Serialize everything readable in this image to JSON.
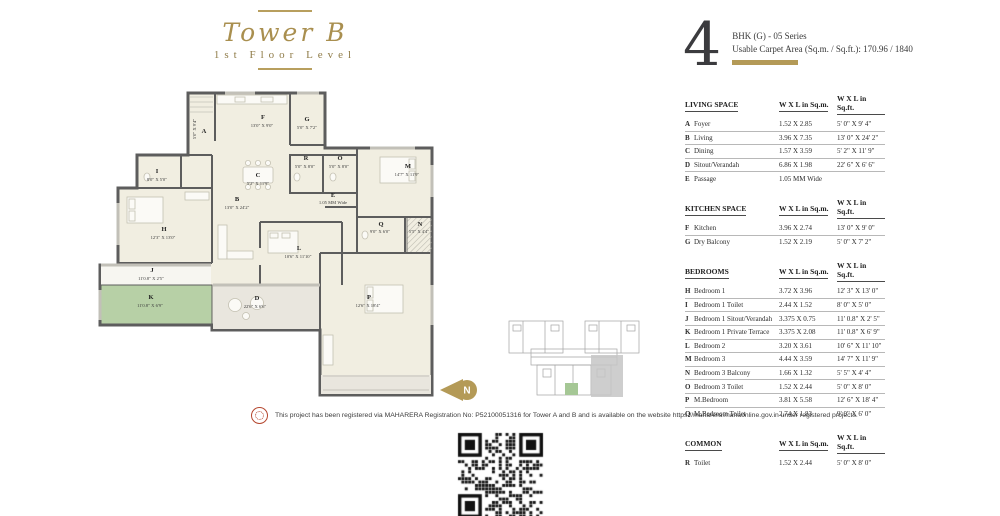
{
  "header": {
    "tower": "Tower B",
    "floor": "1st Floor Level",
    "unit_number": "4",
    "unit_series": "BHK (G)  - 05 Series",
    "carpet_area": "Usable Carpet Area (Sq.m. / Sq.ft.): 170.96 / 1840"
  },
  "tables": [
    {
      "title": "LIVING SPACE",
      "col1": "W X L in Sq.m.",
      "col2": "W X L in Sq.ft.",
      "rows": [
        [
          "A",
          "Foyer",
          "1.52 X 2.85",
          "5' 0\" X 9' 4\""
        ],
        [
          "B",
          "Living",
          "3.96 X 7.35",
          "13' 0\" X 24' 2\""
        ],
        [
          "C",
          "Dining",
          "1.57 X 3.59",
          "5' 2\" X 11' 9\""
        ],
        [
          "D",
          "Sitout/Verandah",
          "6.86 X 1.98",
          "22' 6\" X 6' 6\""
        ],
        [
          "E",
          "Passage",
          "1.05 MM Wide",
          ""
        ]
      ]
    },
    {
      "title": "KITCHEN SPACE",
      "col1": "W X L in Sq.m.",
      "col2": "W X L in Sq.ft.",
      "rows": [
        [
          "F",
          "Kitchen",
          "3.96 X 2.74",
          "13' 0\" X 9' 0\""
        ],
        [
          "G",
          "Dry Balcony",
          "1.52 X 2.19",
          "5' 0\" X 7' 2\""
        ]
      ]
    },
    {
      "title": "BEDROOMS",
      "col1": "W X L in Sq.m.",
      "col2": "W X L in Sq.ft.",
      "rows": [
        [
          "H",
          "Bedroom 1",
          "3.72 X 3.96",
          "12' 3\" X 13' 0\""
        ],
        [
          "I",
          "Bedroom 1 Toilet",
          "2.44 X 1.52",
          "8' 0\" X 5' 0\""
        ],
        [
          "J",
          "Bedroom 1 Sitout/Verandah",
          "3.375 X 0.75",
          "11' 0.8\" X 2' 5\""
        ],
        [
          "K",
          "Bedroom 1 Private Terrace",
          "3.375 X 2.08",
          "11' 0.8\" X 6' 9\""
        ],
        [
          "L",
          "Bedroom 2",
          "3.20 X 3.61",
          "10' 6\" X 11' 10\""
        ],
        [
          "M",
          "Bedroom 3",
          "4.44 X 3.59",
          "14' 7\" X 11' 9\""
        ],
        [
          "N",
          "Bedroom 3 Balcony",
          "1.66 X 1.32",
          "5' 5\" X 4' 4\""
        ],
        [
          "O",
          "Bedroom 3 Toilet",
          "1.52 X 2.44",
          "5' 0\" X 8' 0\""
        ],
        [
          "P",
          "M.Bedroom",
          "3.81 X 5.58",
          "12' 6\" X 18' 4\""
        ],
        [
          "Q",
          "M.Bedroom Toilet",
          "2.74 X 1.83",
          "9' 0\" X 6' 0\""
        ]
      ]
    },
    {
      "title": "COMMON",
      "col1": "W X L in Sq.m.",
      "col2": "W X L in Sq.ft.",
      "rows": [
        [
          "R",
          "Toilet",
          "1.52 X 2.44",
          "5' 0\" X 8' 0\""
        ]
      ]
    }
  ],
  "plan": {
    "compass_label": "N",
    "labels": [
      {
        "letter": "A",
        "dim": "5'0\" X 9'4\""
      },
      {
        "letter": "B",
        "dim": "13'0\" X 24'2\""
      },
      {
        "letter": "C",
        "dim": "5'2\" X 11'9\""
      },
      {
        "letter": "D",
        "dim": "22'6\" X 6'6\""
      },
      {
        "letter": "E",
        "dim": "1.05 MM Wide"
      },
      {
        "letter": "F",
        "dim": "13'0\" X 9'0\""
      },
      {
        "letter": "G",
        "dim": "5'0\" X 7'2\""
      },
      {
        "letter": "H",
        "dim": "12'3\" X 13'0\""
      },
      {
        "letter": "I",
        "dim": "8'0\" X 5'0\""
      },
      {
        "letter": "J",
        "dim": "11'0.8\" X 2'5\""
      },
      {
        "letter": "K",
        "dim": "11'0.8\" X 6'9\""
      },
      {
        "letter": "L",
        "dim": "10'6\" X 11'10\""
      },
      {
        "letter": "M",
        "dim": "14'7\" X 11'9\""
      },
      {
        "letter": "N",
        "dim": "5'5\" X 4'4\""
      },
      {
        "letter": "O",
        "dim": "5'0\" X 8'0\""
      },
      {
        "letter": "P",
        "dim": "12'6\" X 18'4\""
      },
      {
        "letter": "Q",
        "dim": "9'0\" X 6'0\""
      },
      {
        "letter": "R",
        "dim": "5'0\" X 8'0\""
      }
    ]
  },
  "footer": {
    "disclaimer": "This project has been registered via MAHARERA Registration No: P52100051316 for Tower A and B and is available on the website https://maharera.mahaonline.gov.in under registered projects."
  },
  "colors": {
    "gold": "#b49a57",
    "title_gold": "#a98f4f",
    "wall": "#5d5d5d",
    "room_fill": "#f1eee1",
    "terrace_fill": "#e9e6de",
    "green_room": "#b7d0a6"
  }
}
